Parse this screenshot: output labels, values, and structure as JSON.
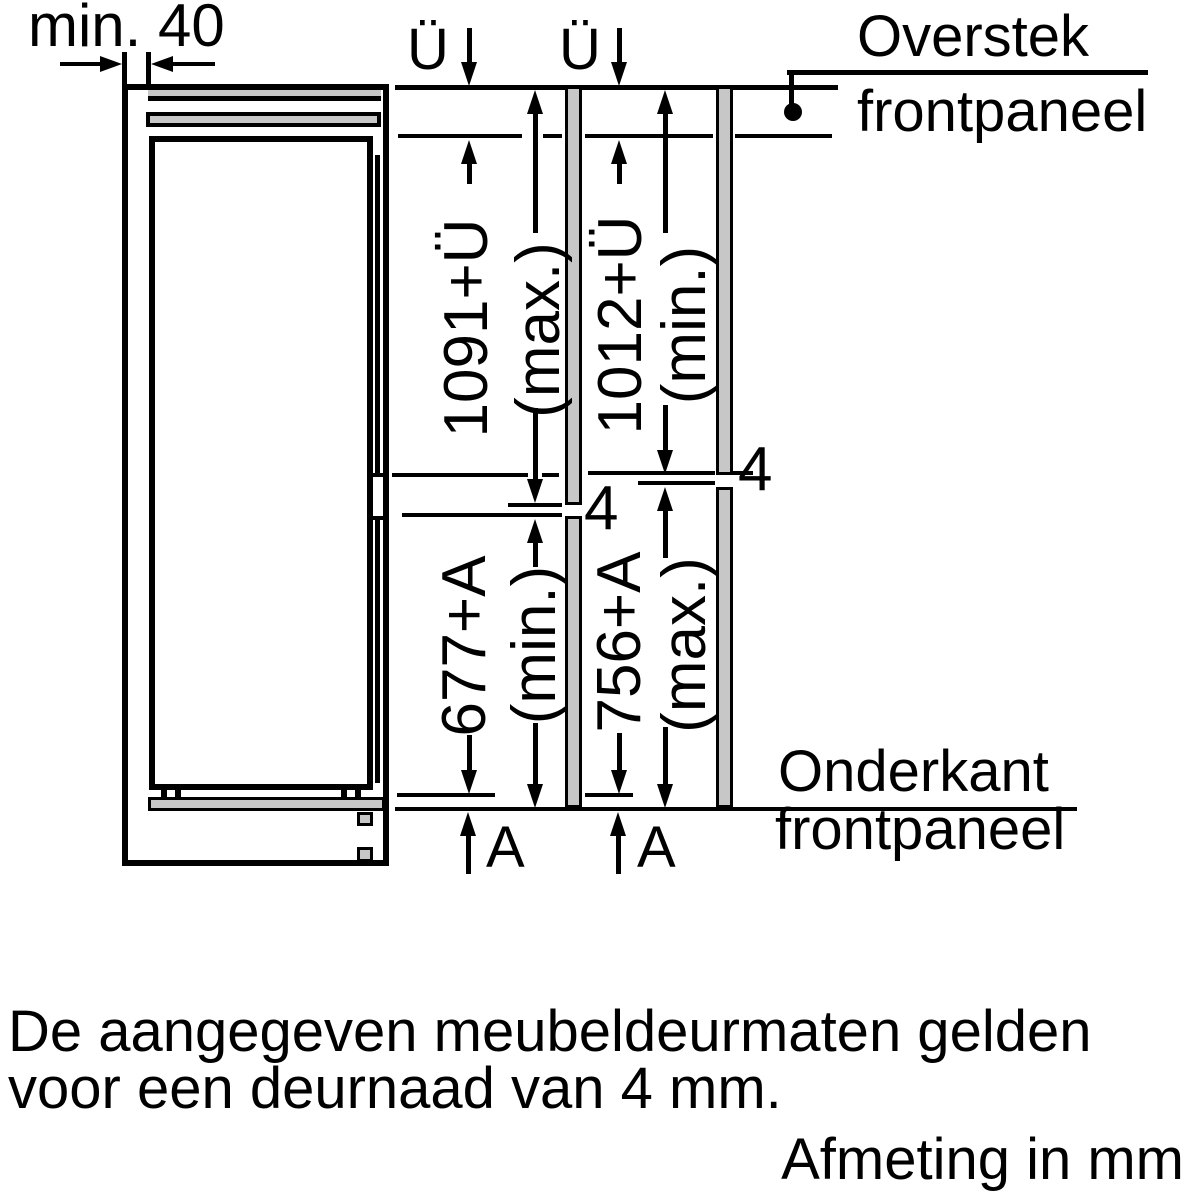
{
  "diagram": {
    "top_dimension": "min. 40",
    "overhang_label": "Ü",
    "bottom_overhang_label": "A",
    "door_gap_value": "4",
    "callout_top": {
      "line1": "Overstek",
      "line2": "frontpaneel"
    },
    "callout_bottom": {
      "line1": "Onderkant",
      "line2": "frontpaneel"
    },
    "dims": {
      "upper_max": {
        "value": "1091+Ü",
        "qualifier": "(max.)"
      },
      "upper_min": {
        "value": "1012+Ü",
        "qualifier": "(min.)"
      },
      "lower_min": {
        "value": "677+A",
        "qualifier": "(min.)"
      },
      "lower_max": {
        "value": "756+A",
        "qualifier": "(max.)"
      }
    }
  },
  "note": {
    "line1": "De aangegeven meubeldeurmaten gelden",
    "line2": "voor een deurnaad van 4 mm."
  },
  "footer": {
    "units": "Afmeting in mm"
  },
  "colors": {
    "line": "#000000",
    "panel_fill": "#c7c7c7",
    "background": "#ffffff"
  }
}
